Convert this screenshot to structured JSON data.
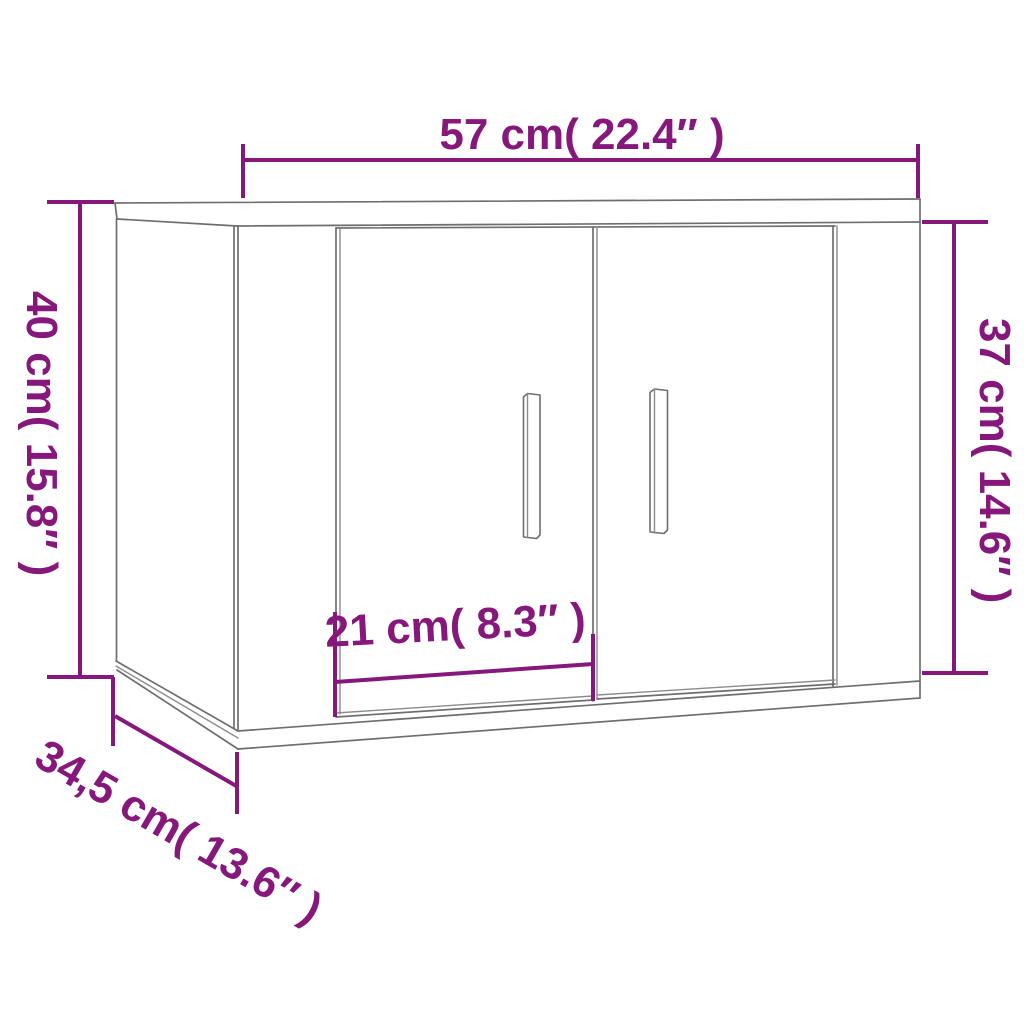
{
  "diagram": {
    "type": "product-dimension-diagram",
    "product": "wall-mounted cabinet with two doors, perspective line drawing",
    "colors": {
      "dimension_accent": "#86187c",
      "outline": "#6e6e6e",
      "background": "#ffffff"
    },
    "dimensions": {
      "width": {
        "label": "57 cm( 22.4″ )",
        "cm": 57,
        "inches": 22.4,
        "position": "top"
      },
      "left_height": {
        "label": "40 cm( 15.8″ )",
        "cm": 40,
        "inches": 15.8,
        "position": "left"
      },
      "right_height": {
        "label": "37 cm( 14.6″ )",
        "cm": 37,
        "inches": 14.6,
        "position": "right"
      },
      "door_width": {
        "label": "21 cm( 8.3″ )",
        "cm": 21,
        "inches": 8.3,
        "position": "bottom-center"
      },
      "depth": {
        "label": "34,5 cm( 13.6″ )",
        "cm": 34.5,
        "inches": 13.6,
        "position": "bottom-left-diagonal"
      }
    }
  }
}
